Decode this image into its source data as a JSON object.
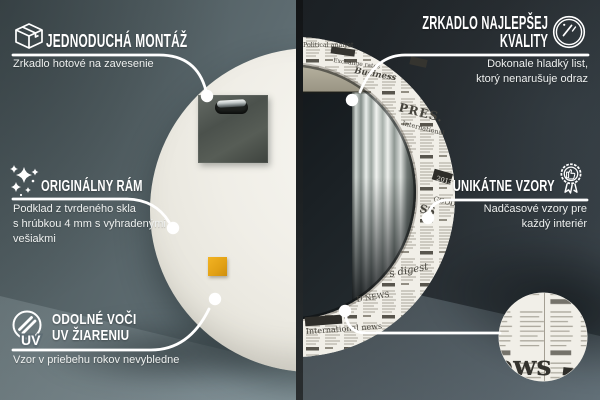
{
  "colors": {
    "left_background": "#5d6b6f",
    "right_background": "#272d31",
    "callout_white": "#ffffff",
    "mirror_back_white": "#efede6",
    "hanger_plate_gray": "#4e534f",
    "sticker_orange": "#e6a81c",
    "newsprint_paper": "#f1efe8",
    "newsprint_ink": "#46443d",
    "glass_dark": "#161b1f"
  },
  "callouts": {
    "easy_mounting": {
      "icon": "package-box-icon",
      "title": "JEDNODUCHÁ MONTÁŽ",
      "subtitle": "Zrkadlo hotové na zavesenie"
    },
    "best_quality": {
      "icon": "mirror-shine-icon",
      "title_line1": "ZRKADLO NAJLEPŠEJ",
      "title_line2": "KVALITY",
      "subtitle_line1": "Dokonale hladký list,",
      "subtitle_line2": "ktorý nenarušuje odraz"
    },
    "original_frame": {
      "icon": "sparkles-icon",
      "title": "ORIGINÁLNY RÁM",
      "subtitle_line1": "Podklad z tvrdeného skla",
      "subtitle_line2": "s hrúbkou 4 mm s vyhradenými",
      "subtitle_line3": "vešiakmi"
    },
    "unique_patterns": {
      "icon": "award-badge-icon",
      "title": "UNIKÁTNE VZORY",
      "subtitle_line1": "Nadčasové vzory pre",
      "subtitle_line2": "každý interiér"
    },
    "uv_resistant": {
      "icon": "uv-sun-icon",
      "icon_label": "UV",
      "title_line1": "ODOLNÉ VOČI",
      "title_line2": "UV ŽIARENIU",
      "subtitle": "Vzor v priebehu rokov nevybledne"
    }
  },
  "newspaper": {
    "words": {
      "political": "Political analyst",
      "exchange": "Exchange rates",
      "business": "Business",
      "press": "PRES.",
      "international": "International",
      "year": "2013",
      "good": "GOOD",
      "ss": "SS",
      "digest": "s digest",
      "d_news": "D NEWS",
      "intl_news": "International news",
      "detail_masthead": "ews"
    }
  }
}
